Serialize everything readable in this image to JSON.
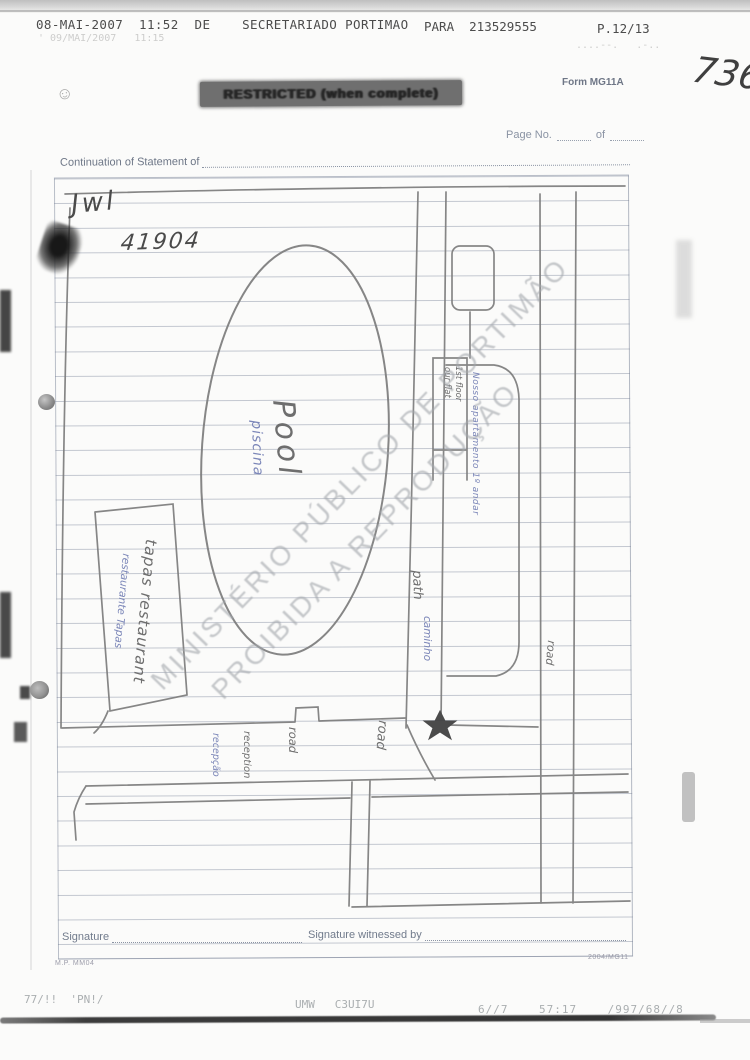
{
  "fax_header": {
    "left_segment": "08-MAI-2007  11:52  DE    SECRETARIADO PORTIMAO",
    "para_segment": "PARA  213529555",
    "page_segment": "P.12/13",
    "ghost_left": "' 09/MAI/2007   11:15",
    "ghost_right": "....--.   .-.."
  },
  "handwritten": {
    "page_number": "736",
    "initials": "Jwl",
    "number": "41904",
    "doodle": "☺"
  },
  "form": {
    "restricted_banner": "RESTRICTED (when complete)",
    "form_code": "Form MG11A",
    "page_no_label": "Page No.",
    "of_label": "of",
    "continuation_label": "Continuation of Statement of",
    "signature_label": "Signature",
    "signature_witnessed_label": "Signature witnessed by",
    "print_code_left": "M.P. MM04",
    "print_code_right": "2004/MG11"
  },
  "map_labels": {
    "pool": "Pool",
    "pool_pt": "piscina",
    "tapas": "tapas restaurant",
    "tapas_pt": "restaurante Tapas",
    "flat_line1": "our flat",
    "flat_line2": "1st floor",
    "flat_pt": "Nosso apartamento 1º andar",
    "path": "path",
    "path_pt": "caminho",
    "road_right": "road",
    "road_mid": "road",
    "road_bottom": "road",
    "reception": "reception",
    "reception_pt": "recepção"
  },
  "watermark": {
    "line1": "MINISTÉRIO PÚBLICO DE PORTIMÃO",
    "line2": "PROIBIDA A REPRODUÇÃO"
  },
  "fax_footer": {
    "left": "77/!!  'PN!/",
    "center": "UMW   C3UI7U",
    "right": "6//7    57:17    /997/68//8"
  },
  "colors": {
    "pencil": "#6e6e6e",
    "blue_pen": "#7b86b8",
    "form_print": "#70798c",
    "watermark": "#a3a7ac",
    "banner_bg": "#6f6f6f"
  }
}
